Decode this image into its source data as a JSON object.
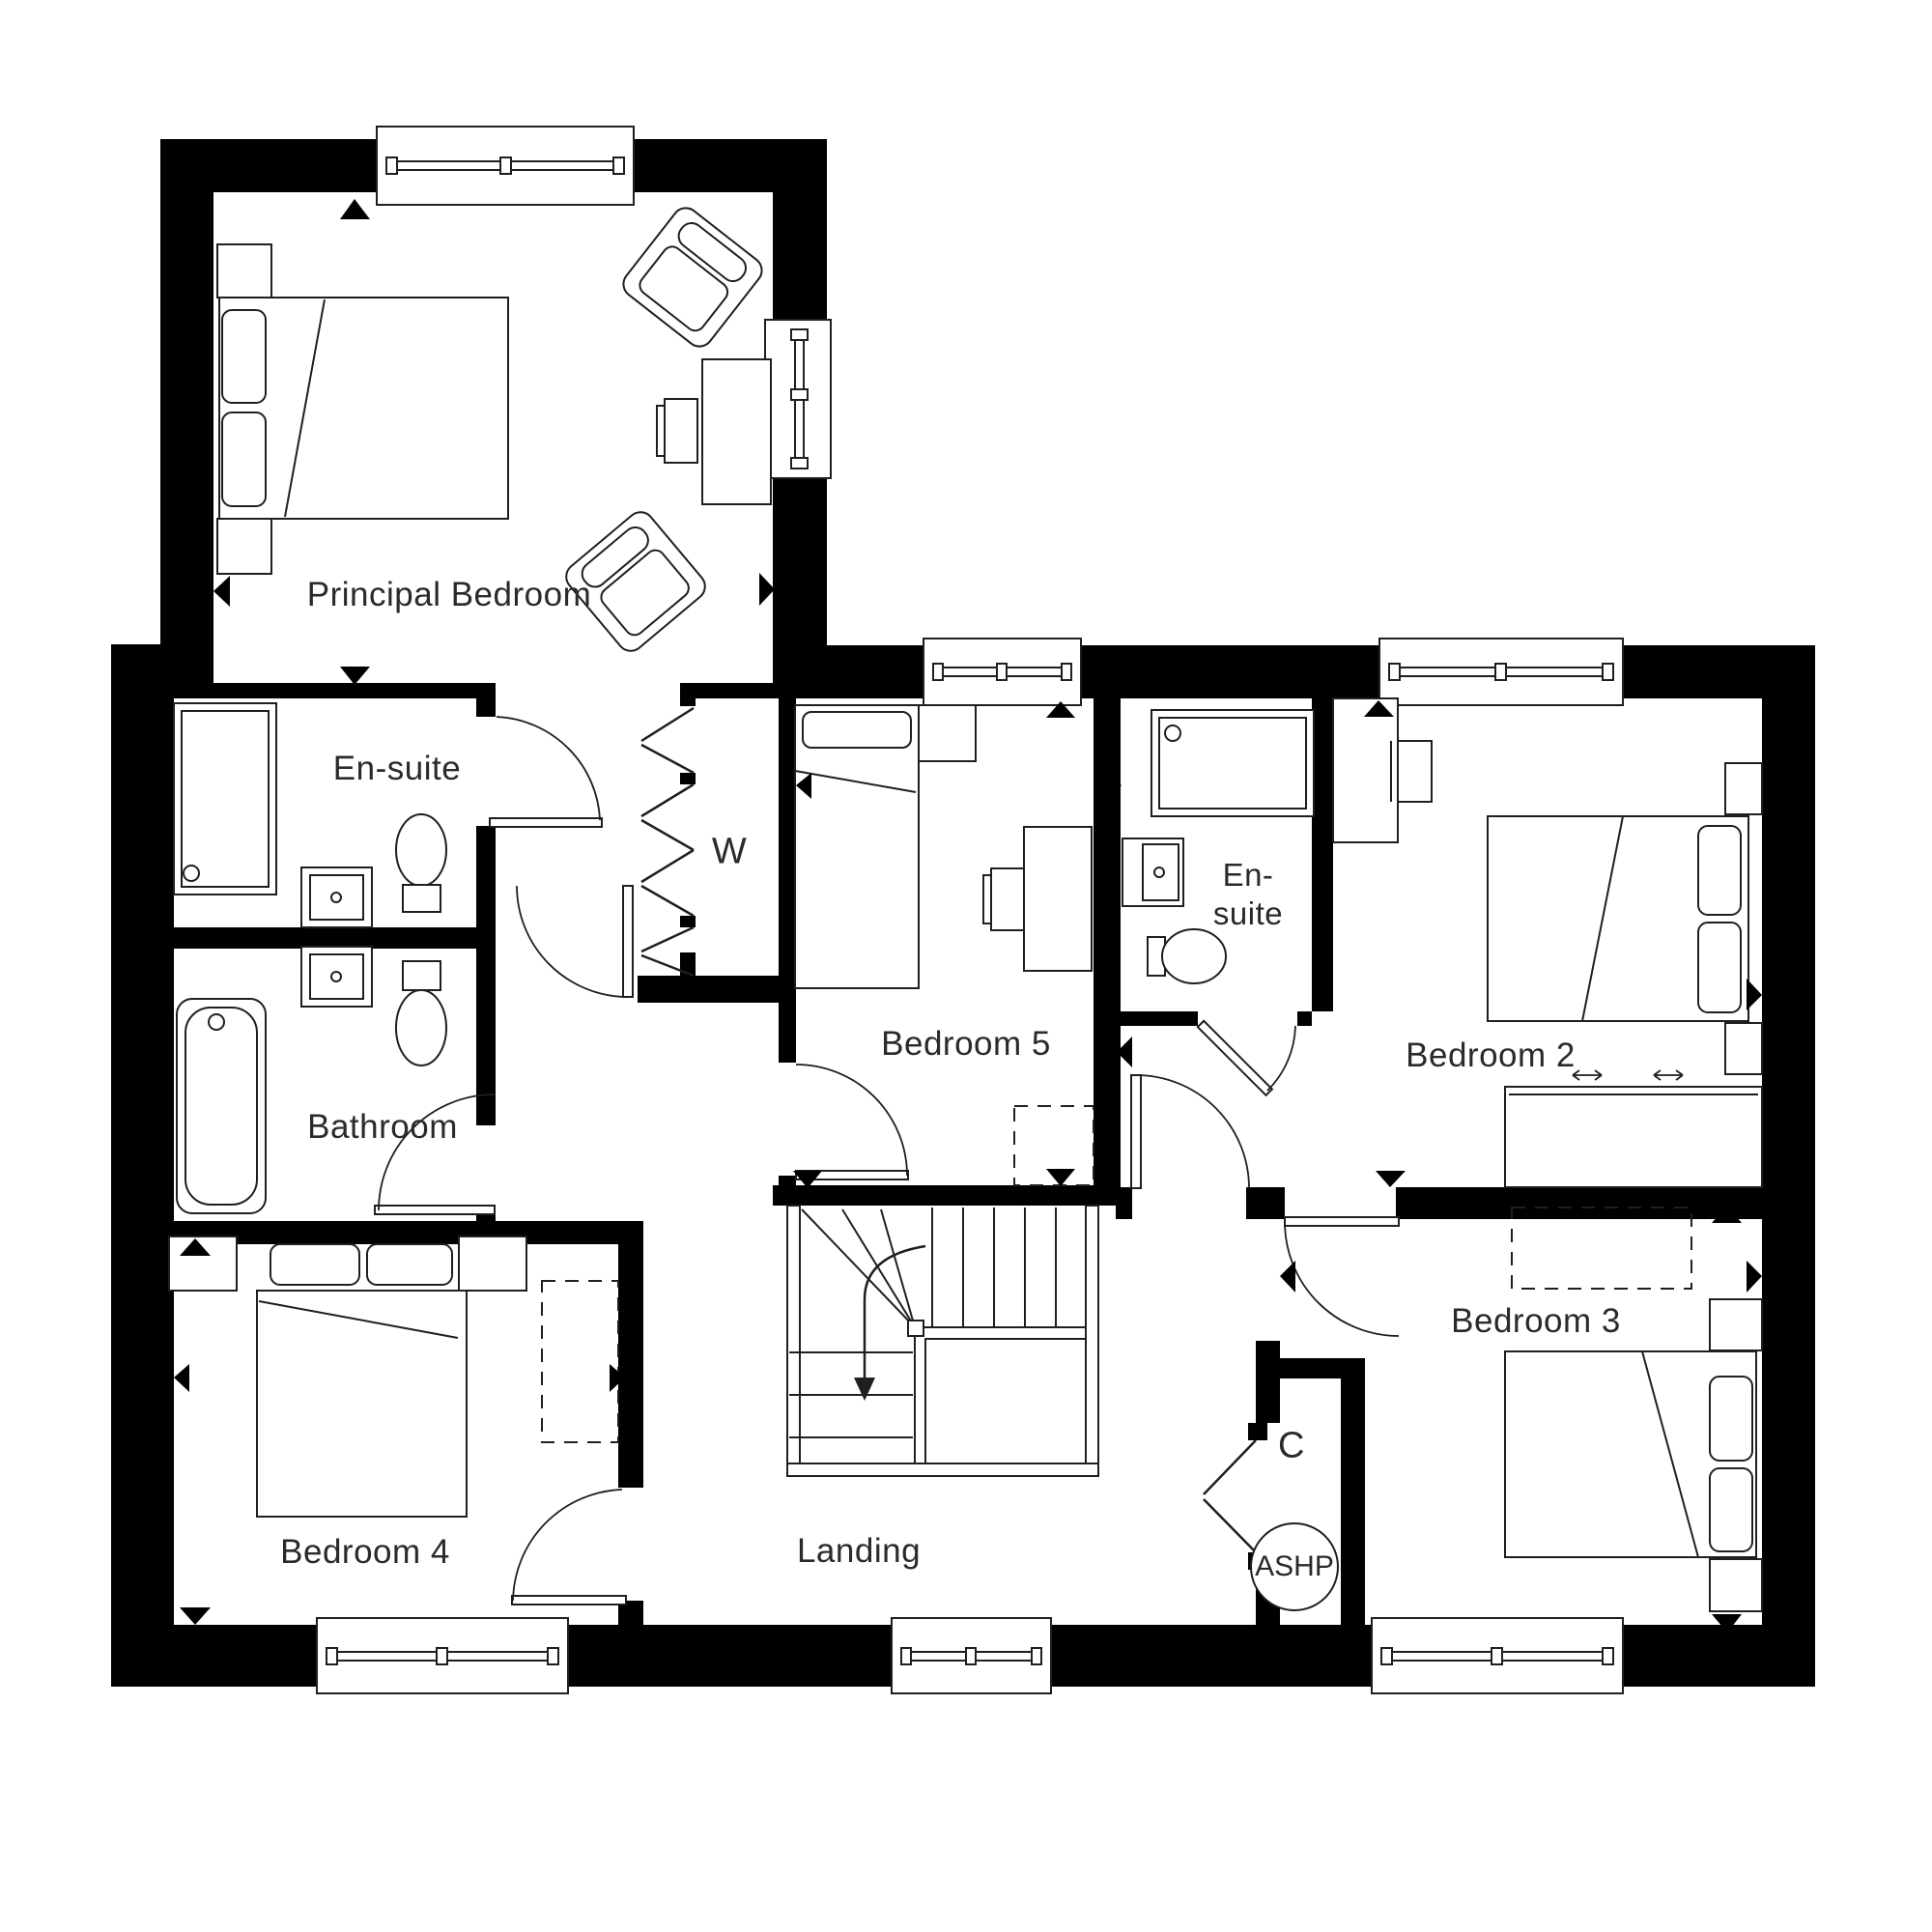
{
  "colors": {
    "wall": "#000000",
    "line": "#1f1f1f",
    "text": "#2a2a2a",
    "background": "#ffffff"
  },
  "rooms": {
    "principal_bedroom": {
      "label": "Principal Bedroom"
    },
    "ensuite1": {
      "label": "En-suite"
    },
    "wardrobe": {
      "label": "W"
    },
    "bedroom5": {
      "label": "Bedroom 5"
    },
    "ensuite2": {
      "label_line1": "En-",
      "label_line2": "suite"
    },
    "bedroom2": {
      "label": "Bedroom 2"
    },
    "bathroom": {
      "label": "Bathroom"
    },
    "bedroom4": {
      "label": "Bedroom 4"
    },
    "bedroom3": {
      "label": "Bedroom 3"
    },
    "landing": {
      "label": "Landing"
    },
    "cupboard": {
      "label": "C"
    },
    "heat_pump": {
      "label": "ASHP"
    }
  }
}
